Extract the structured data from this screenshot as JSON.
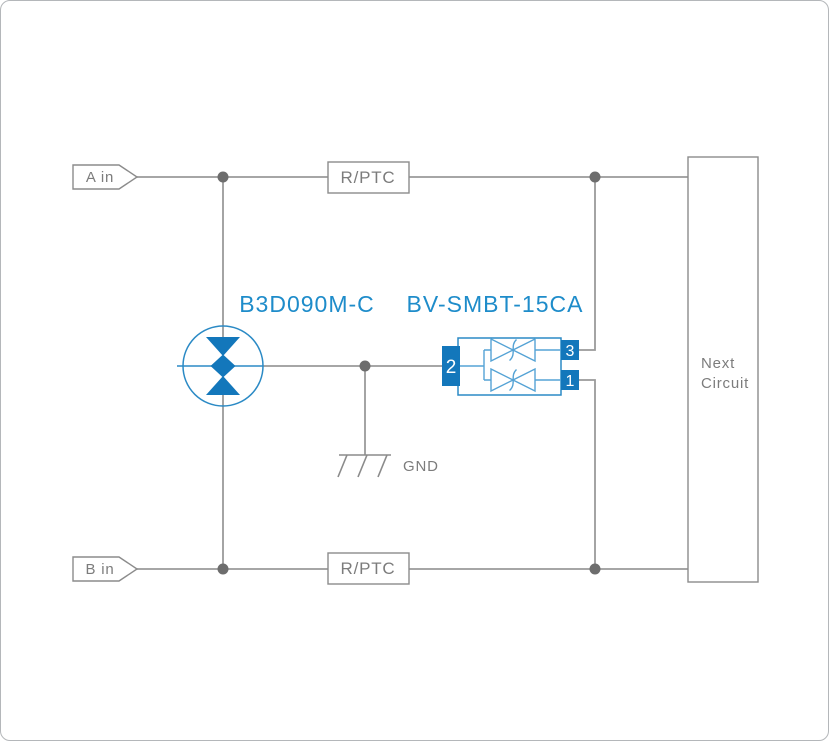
{
  "page": {
    "background": "#ffffff",
    "border_color": "#b4b7ba"
  },
  "labels": {
    "input_a": "A in",
    "input_b": "B in",
    "fuse_top": "R/PTC",
    "fuse_bottom": "R/PTC",
    "ground": "GND",
    "gdt_part_number": "B3D090M-C",
    "tvs_part_number": "BV-SMBT-15CA",
    "next_circuit_line1": "Next",
    "next_circuit_line2": "Circuit"
  },
  "tvs_pins": {
    "left": "2",
    "top_right": "3",
    "bottom_right": "1"
  },
  "colors": {
    "wire_gray": "#9a9a9a",
    "junction_gray": "#6d6d6d",
    "box_stroke_gray": "#8b8b8b",
    "label_gray": "#7c7c7c",
    "blue_solid": "#1377bb",
    "blue_label": "#1e8cca",
    "blue_outline": "#2b8ac5",
    "blue_diode": "#55a3d5"
  }
}
